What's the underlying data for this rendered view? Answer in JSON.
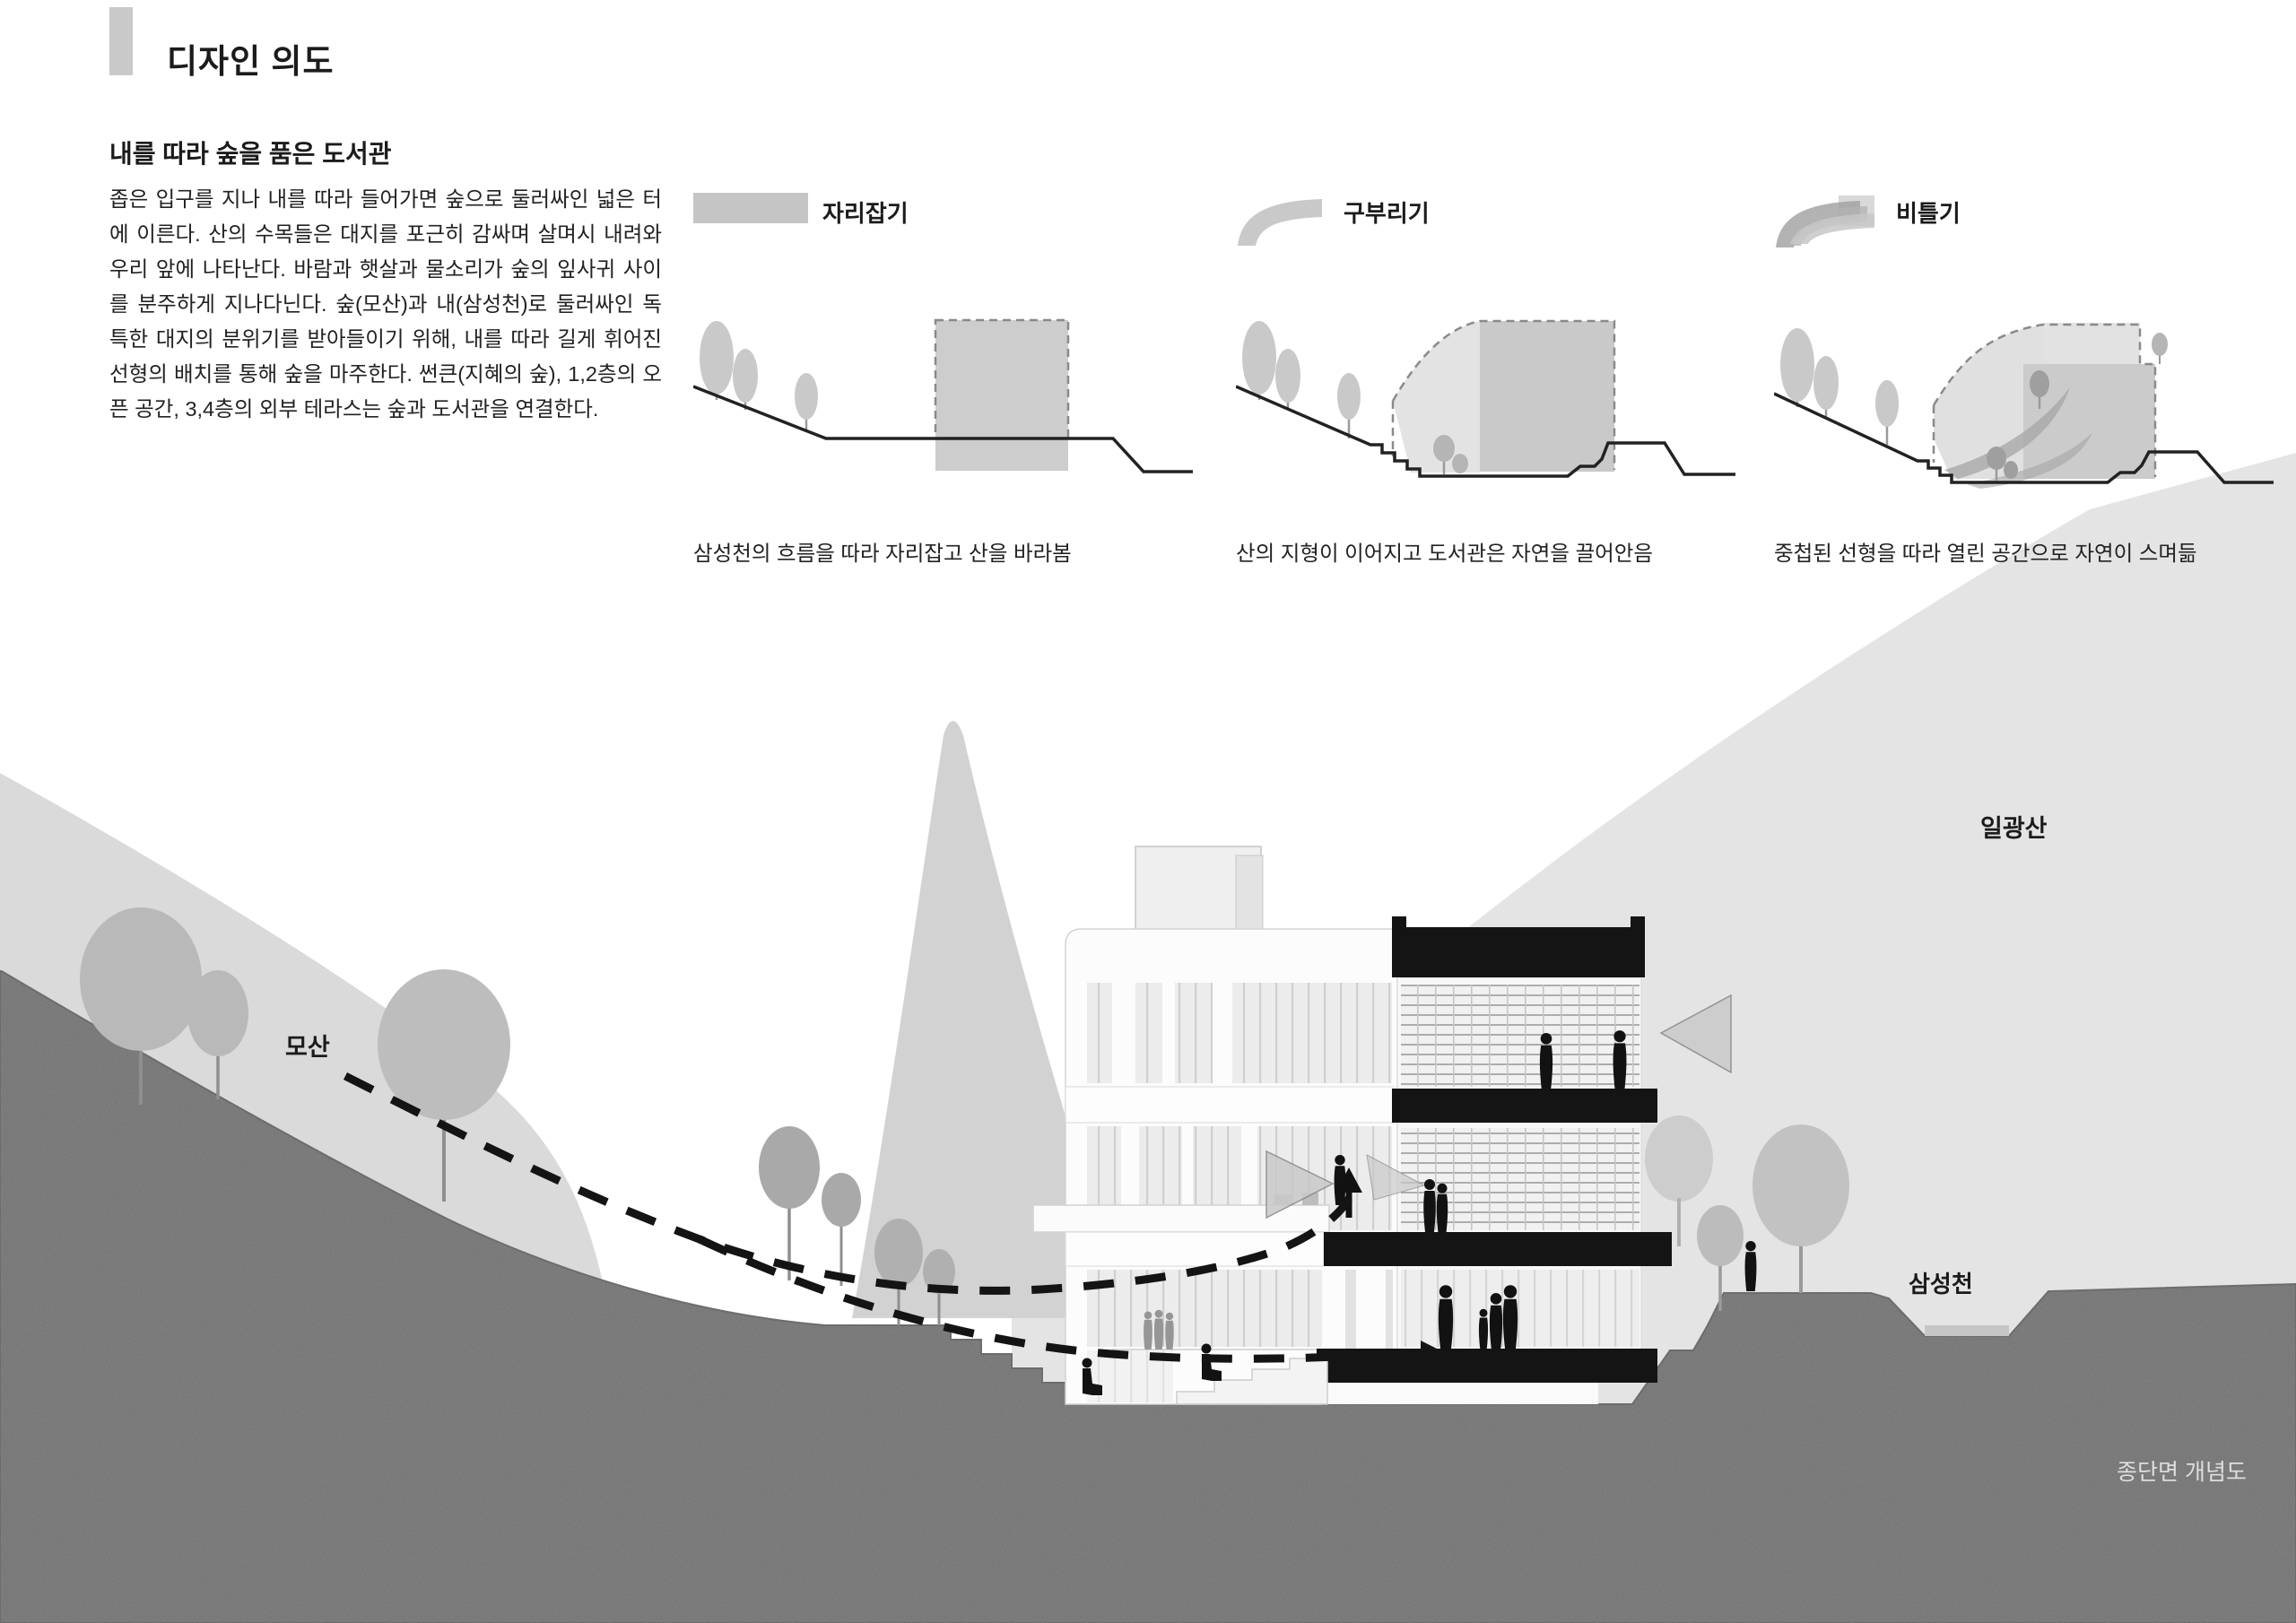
{
  "header": {
    "title": "디자인 의도"
  },
  "intro": {
    "heading": "내를 따라 숲을 품은 도서관",
    "body": "좁은 입구를 지나 내를 따라 들어가면 숲으로 둘러싸인 넓은 터에 이른다. 산의 수목들은 대지를 포근히 감싸며 살며시 내려와 우리 앞에 나타난다. 바람과 햇살과 물소리가 숲의 잎사귀 사이를 분주하게 지나다닌다. 숲(모산)과 내(삼성천)로 둘러싸인 독특한 대지의 분위기를 받아들이기 위해, 내를 따라 길게 휘어진 선형의 배치를 통해 숲을 마주한다. 썬큰(지혜의 숲), 1,2층의 오픈 공간, 3,4층의 외부 테라스는 숲과 도서관을 연결한다."
  },
  "concepts": [
    {
      "label": "자리잡기",
      "icon": "block-bar-icon",
      "caption": "삼성천의 흐름을 따라 자리잡고 산을 바라봄"
    },
    {
      "label": "구부리기",
      "icon": "curved-band-icon",
      "caption": "산의 지형이 이어지고 도서관은 자연을 끌어안음"
    },
    {
      "label": "비틀기",
      "icon": "twisted-bands-icon",
      "caption": "중첩된 선형을 따라 열린 공간으로 자연이 스며듦"
    }
  ],
  "section_drawing": {
    "labels": {
      "left_mountain": "모산",
      "right_mountain": "일광산",
      "stream": "삼성천",
      "drawing_caption": "종단면 개념도"
    },
    "colors": {
      "accent_bar": "#c9c9c9",
      "mountain_light": "#e4e4e4",
      "left_hill_band": "#dadada",
      "valley_hill": "#d2d2d2",
      "ground_dark": "#6e6e6e",
      "stream_water": "#c6c6c6",
      "section_poche": "#141414"
    }
  }
}
